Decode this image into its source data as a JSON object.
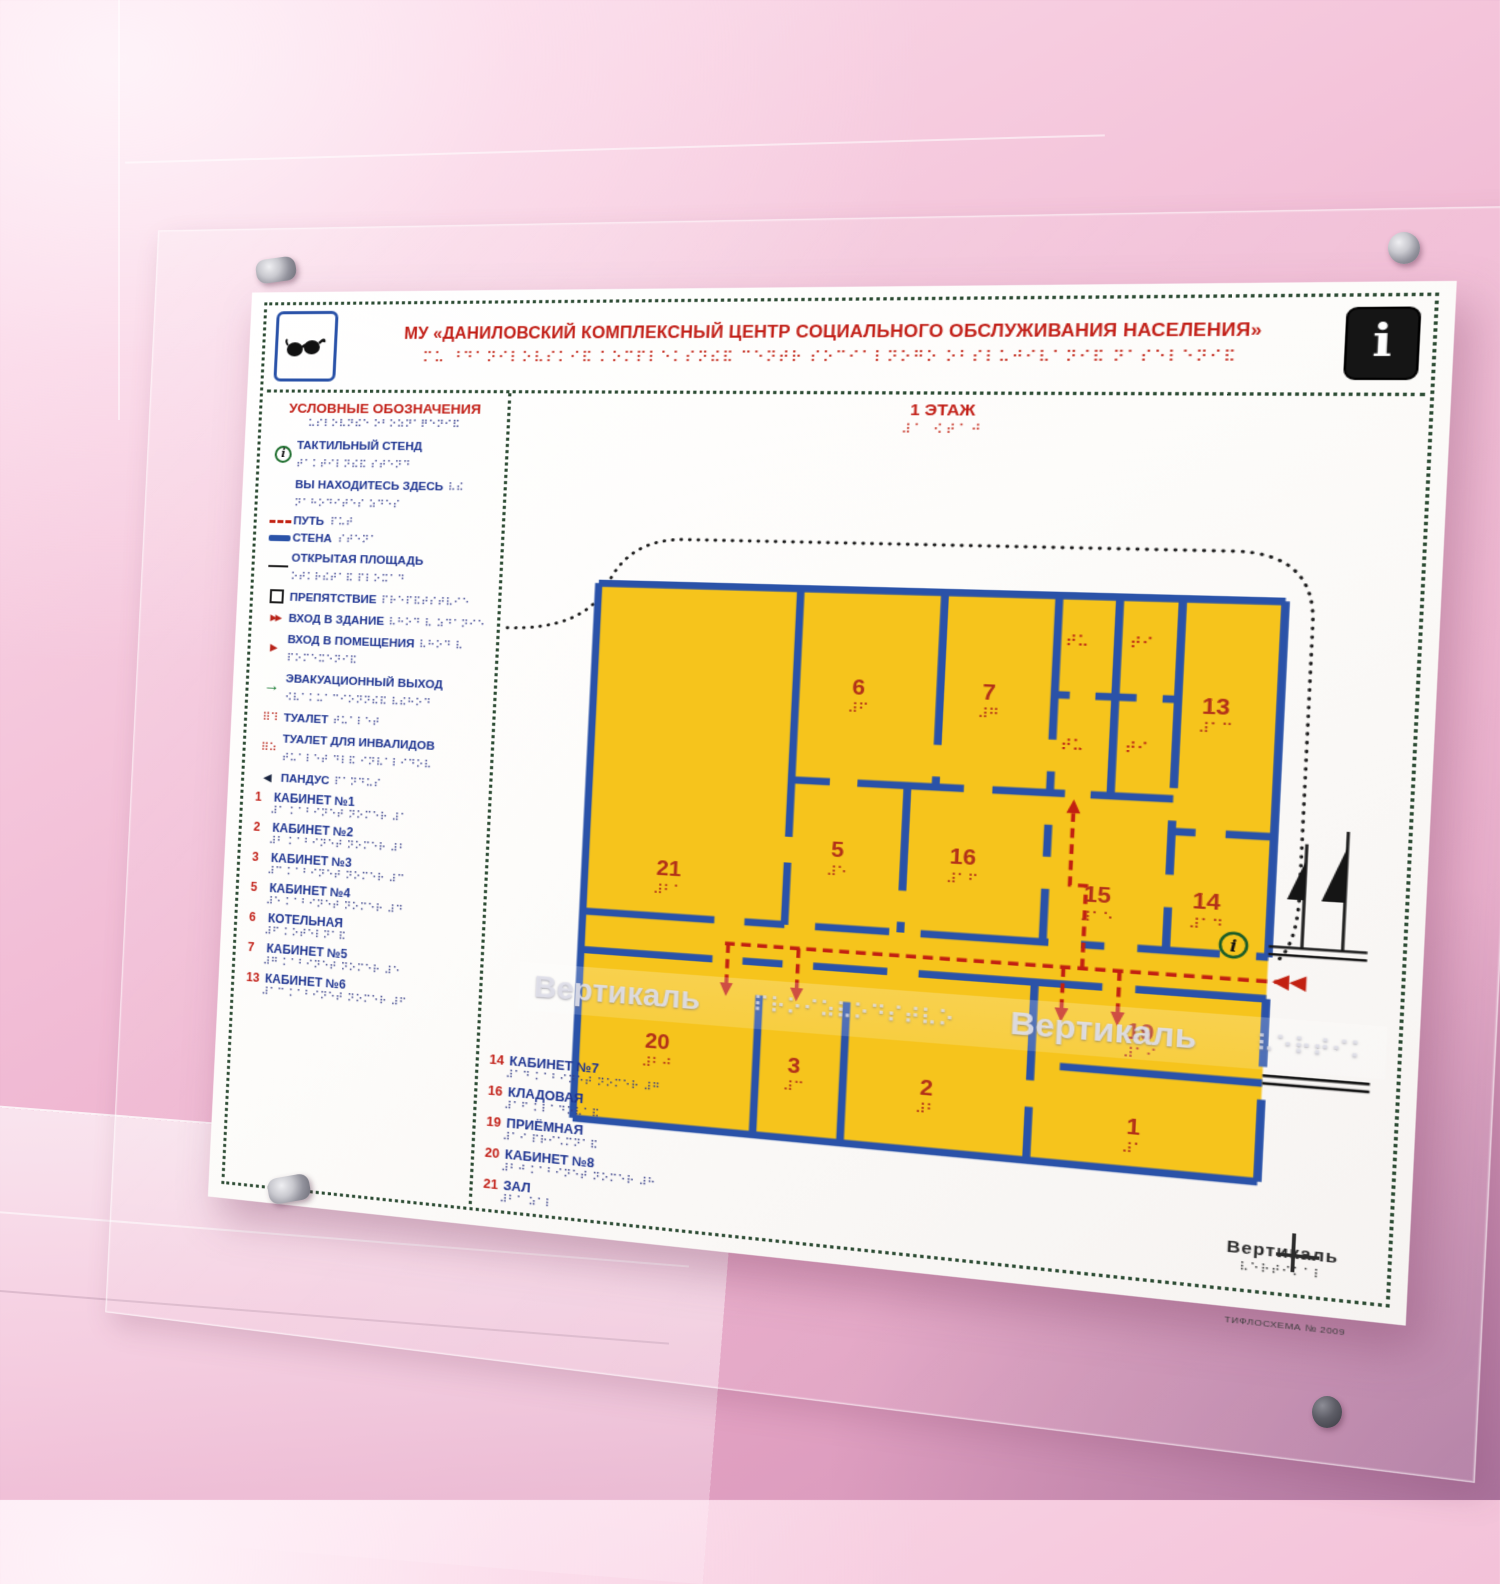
{
  "colors": {
    "panel": "#ffffff",
    "dots_border": "#2c4b33",
    "title_red": "#c22018",
    "label_blue": "#1d3390",
    "plan_yellow": "#f6c41c",
    "wall_blue": "#2a52a8",
    "path_red": "#c22011",
    "wall_pink": "#f1bcd5"
  },
  "header": {
    "title": "МУ «ДАНИЛОВСКИЙ КОМПЛЕКСНЫЙ ЦЕНТР СОЦИАЛЬНОГО ОБСЛУЖИВАНИЯ НАСЕЛЕНИЯ»",
    "title_braille": "⠍⠥ ⠘⠙⠁⠝⠊⠇⠕⠧⠎⠅⠊⠯ ⠅⠕⠍⠏⠇⠑⠅⠎⠝⠮⠯ ⠉⠑⠝⠞⠗ ⠎⠕⠉⠊⠁⠇⠝⠕⠛⠕ ⠕⠃⠎⠇⠥⠚⠊⠧⠁⠝⠊⠯ ⠝⠁⠎⠑⠇⠑⠝⠊⠯",
    "glasses_icon": "glasses-icon",
    "info_icon_glyph": "i"
  },
  "legend": {
    "heading": "УСЛОВНЫЕ ОБОЗНАЧЕНИЯ",
    "heading_braille": "⠥⠎⠇⠕⠧⠝⠮⠑ ⠕⠃⠕⠵⠝⠁⠟⠑⠝⠊⠯",
    "items": [
      {
        "label": "ТАКТИЛЬНЫЙ СТЕНД",
        "braille": "⠞⠁⠅⠞⠊⠇⠝⠮⠯ ⠎⠞⠑⠝⠙",
        "symbol": "info-circle",
        "class": "block"
      },
      {
        "label": "ВЫ НАХОДИТЕСЬ ЗДЕСЬ",
        "braille": "⠧⠮ ⠝⠁⠓⠕⠙⠊⠞⠑⠎ ⠵⠙⠑⠎",
        "symbol": "none",
        "class": "block"
      },
      {
        "label": "ПУТЬ",
        "braille": "⠏⠥⠞",
        "symbol": "path-dash",
        "class": "inline"
      },
      {
        "label": "СТЕНА",
        "braille": "⠎⠞⠑⠝⠁",
        "symbol": "wall-bar",
        "class": "inline"
      },
      {
        "label": "ОТКРЫТАЯ ПЛОЩАДЬ",
        "braille": "⠕⠞⠅⠗⠮⠞⠁⠯ ⠏⠇⠕⠭⠁⠙",
        "symbol": "thin-line",
        "class": "block"
      },
      {
        "label": "ПРЕПЯТСТВИЕ",
        "braille": "⠏⠗⠑⠏⠯⠞⠎⠞⠧⠊⠑",
        "symbol": "square",
        "class": "block"
      },
      {
        "label": "ВХОД В ЗДАНИЕ",
        "braille": "⠧⠓⠕⠙ ⠧ ⠵⠙⠁⠝⠊⠑",
        "symbol": "double-arrow",
        "class": "block"
      },
      {
        "label": "ВХОД В ПОМЕЩЕНИЯ",
        "braille": "⠧⠓⠕⠙ ⠧ ⠏⠕⠍⠑⠭⠑⠝⠊⠯",
        "symbol": "arrow",
        "class": "block"
      },
      {
        "label": "ЭВАКУАЦИОННЫЙ ВЫХОД",
        "braille": "⠪⠧⠁⠅⠥⠁⠉⠊⠕⠝⠝⠮⠯ ⠧⠮⠓⠕⠙",
        "symbol": "green-arrow",
        "class": "block"
      },
      {
        "label": "ТУАЛЕТ",
        "braille": "⠞⠥⠁⠇⠑⠞",
        "symbol": "braille-red",
        "class": "block red-braille"
      },
      {
        "label": "ТУАЛЕТ ДЛЯ ИНВАЛИДОВ",
        "braille": "⠞⠥⠁⠇⠑⠞ ⠙⠇⠯ ⠊⠝⠧⠁⠇⠊⠙⠕⠧",
        "symbol": "braille-red2",
        "class": "block red-braille"
      },
      {
        "label": "ПАНДУС",
        "braille": "⠏⠁⠝⠙⠥⠎",
        "symbol": "triangle",
        "class": "block"
      }
    ],
    "rooms_left": [
      {
        "num": "1",
        "name": "КАБИНЕТ №1",
        "braille": "⠼⠁ ⠅⠁⠃⠊⠝⠑⠞ ⠝⠕⠍⠑⠗ ⠼⠁"
      },
      {
        "num": "2",
        "name": "КАБИНЕТ №2",
        "braille": "⠼⠃ ⠅⠁⠃⠊⠝⠑⠞ ⠝⠕⠍⠑⠗ ⠼⠃"
      },
      {
        "num": "3",
        "name": "КАБИНЕТ №3",
        "braille": "⠼⠉ ⠅⠁⠃⠊⠝⠑⠞ ⠝⠕⠍⠑⠗ ⠼⠉"
      },
      {
        "num": "5",
        "name": "КАБИНЕТ №4",
        "braille": "⠼⠑ ⠅⠁⠃⠊⠝⠑⠞ ⠝⠕⠍⠑⠗ ⠼⠙"
      },
      {
        "num": "6",
        "name": "КОТЕЛЬНАЯ",
        "braille": "⠼⠋ ⠅⠕⠞⠑⠇⠝⠁⠯"
      },
      {
        "num": "7",
        "name": "КАБИНЕТ №5",
        "braille": "⠼⠛ ⠅⠁⠃⠊⠝⠑⠞ ⠝⠕⠍⠑⠗ ⠼⠑"
      },
      {
        "num": "13",
        "name": "КАБИНЕТ №6",
        "braille": "⠼⠁⠉ ⠅⠁⠃⠊⠝⠑⠞ ⠝⠕⠍⠑⠗ ⠼⠋"
      }
    ],
    "rooms_bottom": [
      {
        "num": "14",
        "name": "КАБИНЕТ №7",
        "braille": "⠼⠁⠙ ⠅⠁⠃⠊⠝⠑⠞ ⠝⠕⠍⠑⠗ ⠼⠛"
      },
      {
        "num": "16",
        "name": "КЛАДОВАЯ",
        "braille": "⠼⠁⠋ ⠅⠇⠁⠙⠕⠧⠁⠯"
      },
      {
        "num": "19",
        "name": "ПРИЁМНАЯ",
        "braille": "⠼⠁⠊ ⠏⠗⠊⠡⠍⠝⠁⠯"
      },
      {
        "num": "20",
        "name": "КАБИНЕТ №8",
        "braille": "⠼⠃⠚ ⠅⠁⠃⠊⠝⠑⠞ ⠝⠕⠍⠑⠗ ⠼⠓"
      },
      {
        "num": "21",
        "name": "ЗАЛ",
        "braille": "⠼⠃⠁ ⠵⠁⠇"
      }
    ]
  },
  "plan": {
    "floor_label": "1 ЭТАЖ",
    "floor_braille": "⠼⠁ ⠪⠞⠁⠚",
    "rooms": [
      {
        "num": "21",
        "braille": "⠼⠃⠁",
        "x": 95,
        "y": 300
      },
      {
        "num": "6",
        "braille": "⠼⠋",
        "x": 262,
        "y": 115
      },
      {
        "num": "7",
        "braille": "⠼⠛",
        "x": 378,
        "y": 115
      },
      {
        "num": "13",
        "braille": "⠼⠁⠉",
        "x": 572,
        "y": 120
      },
      {
        "num": "5",
        "braille": "⠼⠑",
        "x": 250,
        "y": 272
      },
      {
        "num": "16",
        "braille": "⠼⠁⠋",
        "x": 362,
        "y": 272
      },
      {
        "num": "15",
        "braille": "⠼⠁⠑",
        "x": 480,
        "y": 300
      },
      {
        "num": "14",
        "braille": "⠼⠁⠙",
        "x": 572,
        "y": 300
      },
      {
        "num": "20",
        "braille": "⠼⠃⠚",
        "x": 92,
        "y": 470
      },
      {
        "num": "3",
        "braille": "⠼⠉",
        "x": 220,
        "y": 482
      },
      {
        "num": "2",
        "braille": "⠼⠃",
        "x": 340,
        "y": 492
      },
      {
        "num": "19",
        "braille": "⠼⠁⠊",
        "x": 522,
        "y": 424
      },
      {
        "num": "1",
        "braille": "⠼⠁",
        "x": 520,
        "y": 512
      }
    ],
    "toilet_cells": [
      {
        "braille": "⠞⠥",
        "x": 452,
        "y": 62
      },
      {
        "braille": "⠞⠊",
        "x": 507,
        "y": 62
      },
      {
        "braille": "⠞⠥",
        "x": 452,
        "y": 160
      },
      {
        "braille": "⠞⠊",
        "x": 507,
        "y": 160
      }
    ],
    "you_are_here_glyph": "i"
  },
  "watermark": {
    "text1": "Вертикаль",
    "braille": "⠏⠗⠕⠊⠵⠧⠕⠙⠎⠞⠧⠕",
    "text2": "Вертикаль",
    "braille2": "⠧⠑⠗⠞⠊⠅"
  },
  "footer": {
    "logo": "Вертикаль",
    "logo_braille": "⠧⠑⠗⠞⠊⠅⠁⠇",
    "caption": "ТИФЛОСХЕМА № 2009"
  }
}
